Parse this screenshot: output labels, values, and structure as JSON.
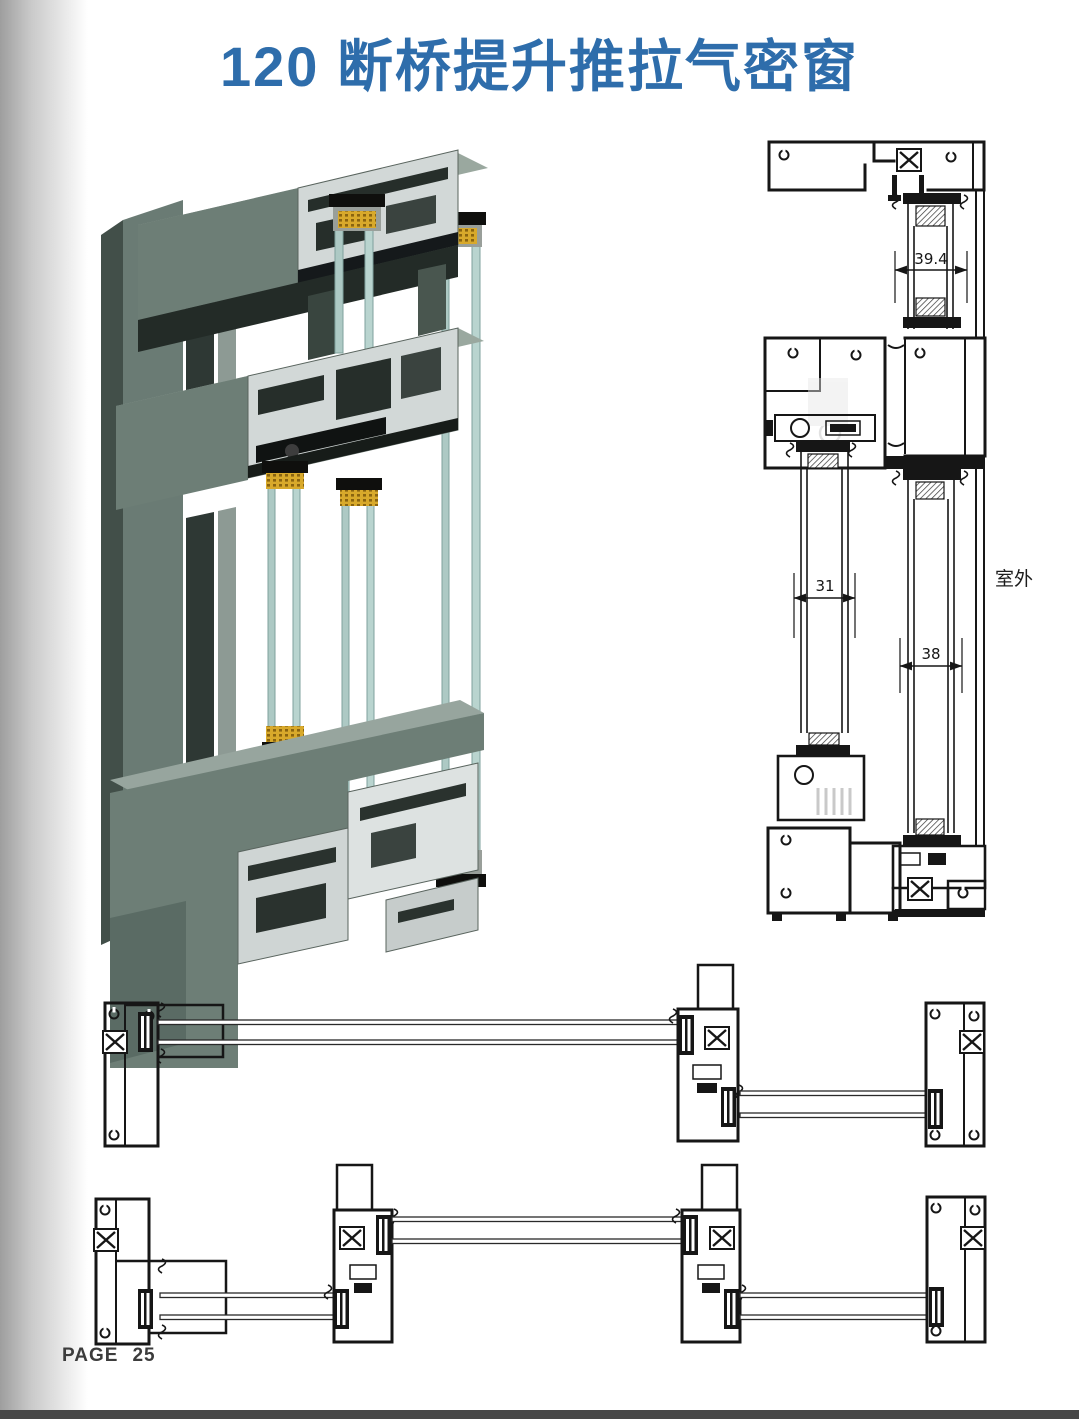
{
  "title": "120 断桥提升推拉气密窗",
  "footer": {
    "page_label": "PAGE",
    "page_number": "25"
  },
  "vertical_section": {
    "dim_top_glass": "39.4",
    "dim_inner_glass": "31",
    "dim_outer_glass": "38",
    "outdoor_label": "室外"
  },
  "colors": {
    "title_blue": "#2e6dab",
    "drawing_ink": "#161616",
    "profile_sage": "#6d7e76",
    "profile_sage_light": "#9aa89f",
    "profile_sage_dark": "#424f49",
    "cut_face_silver": "#d2d8d7",
    "glass_teal": "#adc9c4",
    "spacer_yellow": "#d8a92b",
    "footer_bar_gray": "#474747"
  }
}
